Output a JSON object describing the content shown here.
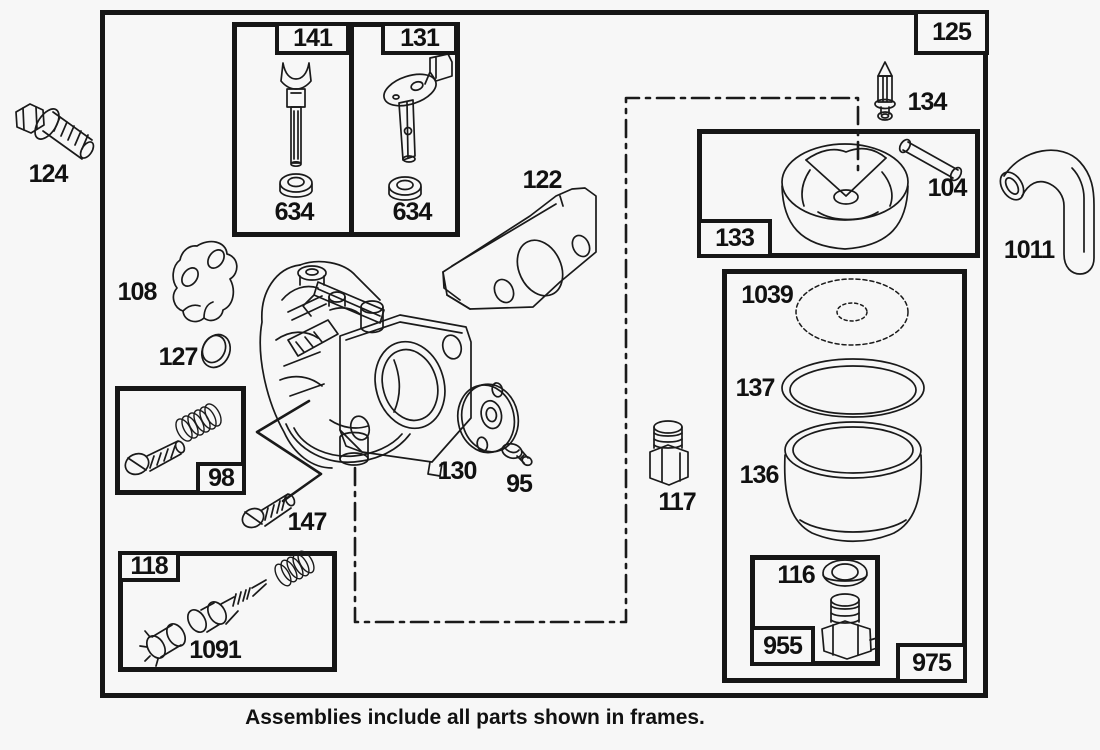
{
  "caption": "Assemblies include all parts shown in frames.",
  "frames": {
    "f125": "125",
    "f141": "141",
    "f131": "131",
    "f133": "133",
    "f98": "98",
    "f118": "118",
    "f955": "955",
    "f975": "975"
  },
  "parts": {
    "p124": "124",
    "p634a": "634",
    "p634b": "634",
    "p108": "108",
    "p127": "127",
    "p122": "122",
    "p134": "134",
    "p104": "104",
    "p1011": "1011",
    "p147": "147",
    "p130": "130",
    "p95": "95",
    "p117": "117",
    "p1039": "1039",
    "p137": "137",
    "p136": "136",
    "p116": "116",
    "p1091": "1091"
  },
  "colors": {
    "ink": "#1a1a1a",
    "background": "#f7f7f7"
  }
}
